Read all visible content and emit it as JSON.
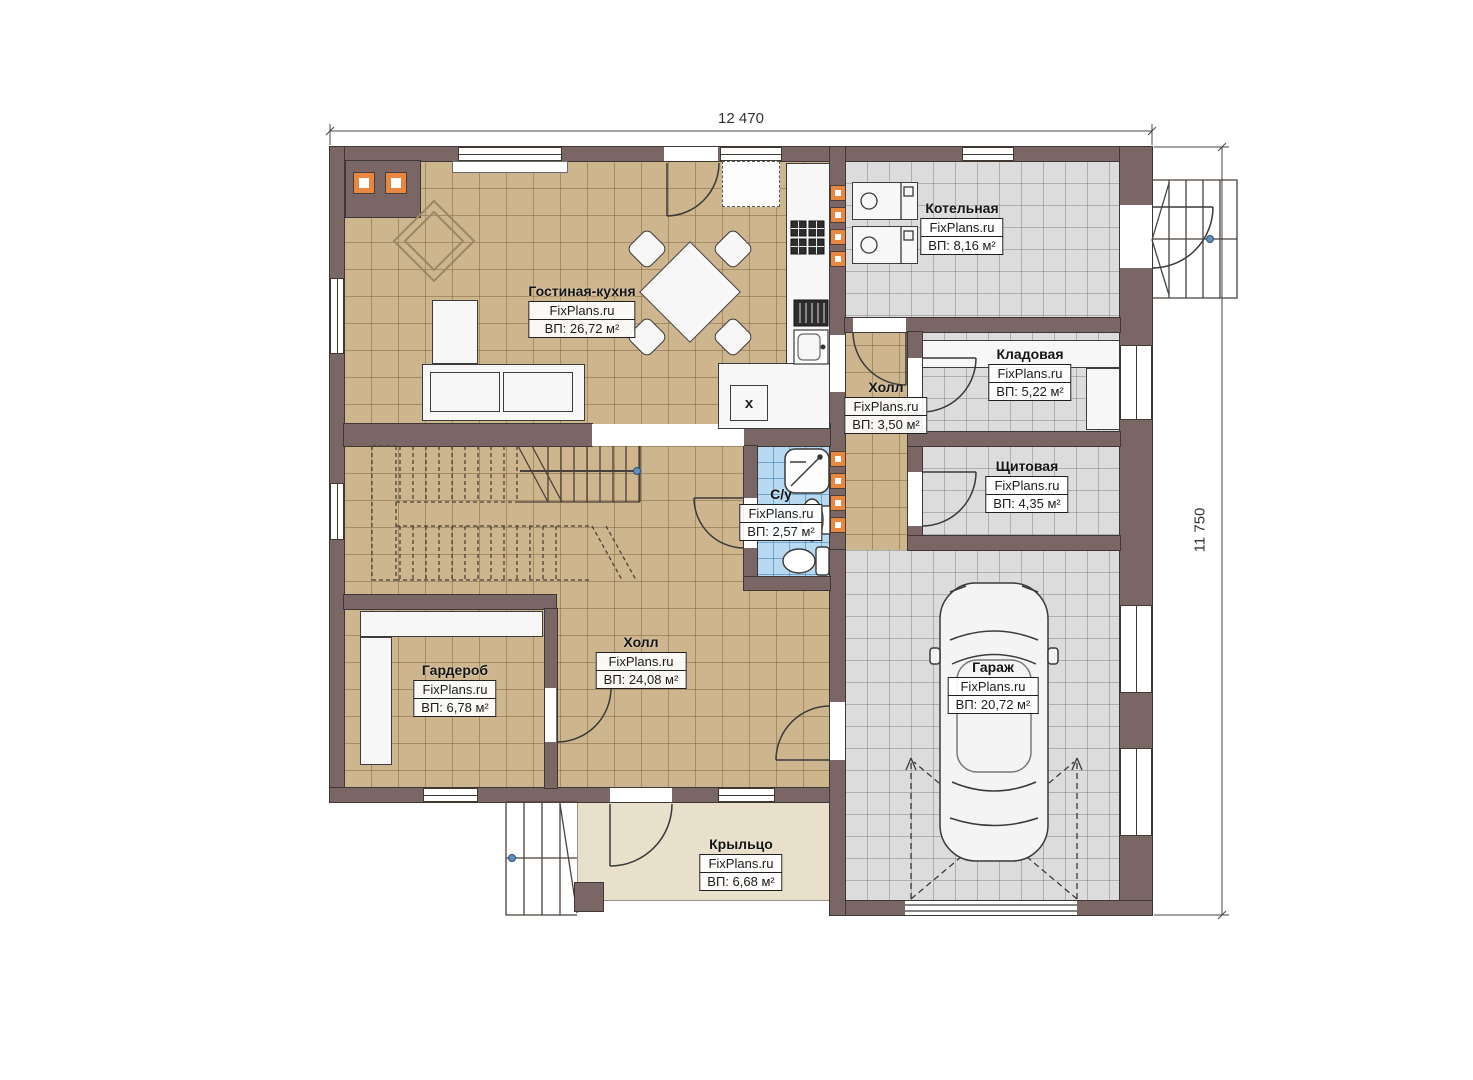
{
  "plan": {
    "watermark": "FixPlans.ru",
    "dimensions": {
      "width": "12 470",
      "height": "11 750"
    },
    "rooms": [
      {
        "name": "Гостиная-кухня",
        "area": "ВП: 26,72 м²"
      },
      {
        "name": "Котельная",
        "area": "ВП: 8,16 м²"
      },
      {
        "name": "Кладовая",
        "area": "ВП: 5,22 м²"
      },
      {
        "name": "Щитовая",
        "area": "ВП: 4,35 м²"
      },
      {
        "name": "Холл",
        "area": "ВП: 3,50 м²"
      },
      {
        "name": "С/у",
        "area": "ВП: 2,57 м²"
      },
      {
        "name": "Холл",
        "area": "ВП: 24,08 м²"
      },
      {
        "name": "Гардероб",
        "area": "ВП: 6,78 м²"
      },
      {
        "name": "Гараж",
        "area": "ВП: 20,72 м²"
      },
      {
        "name": "Крыльцо",
        "area": "ВП: 6,68 м²"
      }
    ],
    "marks": {
      "washer": "x"
    },
    "colors": {
      "wall": "#7a6765",
      "floor_wood": "#cdb58d",
      "floor_tile": "#dcdcdc",
      "floor_bath": "#b7d9f1",
      "floor_porch": "#e9e0cb",
      "vent": "#e8873f",
      "handrail_dot": "#5f8fc0"
    }
  }
}
